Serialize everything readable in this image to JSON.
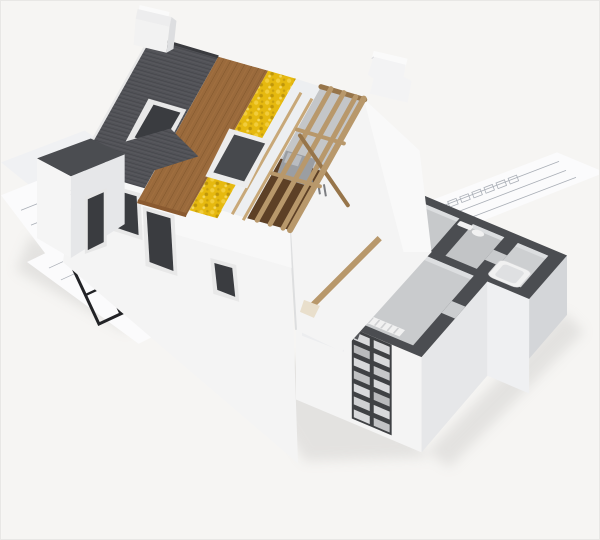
{
  "meta": {
    "description": "3D architectural rendering of a cutaway house model resting on blueprint floor-plan sheets; the roof is peeled back in layers (shingles, wood sheathing, yellow insulation, white membrane, open timber rafters) and the ground floor is sliced open showing room plan with dark cut walls"
  },
  "palette": {
    "background": "#f6f5f3",
    "wall_white": "#f4f4f4",
    "wall_shade": "#e6e7e9",
    "wall_shade_dark": "#d4d6d9",
    "shingle_dark": "#515257",
    "shingle_line": "#3d3e42",
    "sheathing_wood": "#9a6a3c",
    "sheathing_line": "#7a5128",
    "insulation_yellow": "#e6b90f",
    "membrane_white": "#edeff1",
    "timber": "#b8986b",
    "timber_dark": "#97754a",
    "attic_floor_brown": "#5d4026",
    "attic_wall": "#c4c6c8",
    "cut_wall_dark": "#4b4d51",
    "plan_floor": "#c9cbcd",
    "plan_floor_light": "#dcdee0",
    "fixture_white": "#f1f1f1",
    "glass_dark": "#3a3c40",
    "blueprint_paper": "#fbfbfc",
    "blueprint_paper_shaded": "#f0f1f3",
    "blueprint_line": "#a9aeb6",
    "blueprint_wall_bold": "#222326",
    "shadow": "#b9b8b6"
  },
  "scene": {
    "elements": [
      {
        "name": "blueprint-sheets",
        "label": "floor-plan blueprint sheets under the model"
      },
      {
        "name": "bold-floor-plan",
        "label": "bold black floor plan drawing"
      },
      {
        "name": "ridge-chimney",
        "label": "white chimney at roof ridge"
      },
      {
        "name": "gable-chimney",
        "label": "stepped chimney on gable wall"
      },
      {
        "name": "shingle-band",
        "label": "dark roof shingles layer"
      },
      {
        "name": "sheathing-band",
        "label": "wood sheathing layer"
      },
      {
        "name": "insulation-band",
        "label": "yellow insulation layer"
      },
      {
        "name": "membrane-band",
        "label": "white underlayment layer"
      },
      {
        "name": "rafter-frame",
        "label": "open timber rafters over attic"
      },
      {
        "name": "skylights",
        "label": "two roof windows"
      },
      {
        "name": "gable-wall",
        "label": "white gable end wall"
      },
      {
        "name": "front-wall",
        "label": "front wall with dark windows"
      },
      {
        "name": "porch",
        "label": "flat-roofed porch wing"
      },
      {
        "name": "cutaway-floor",
        "label": "sliced ground floor with dark wall tops, rooms, bath and kitchen"
      },
      {
        "name": "brick-section",
        "label": "exposed brick wall cross-section"
      }
    ]
  }
}
